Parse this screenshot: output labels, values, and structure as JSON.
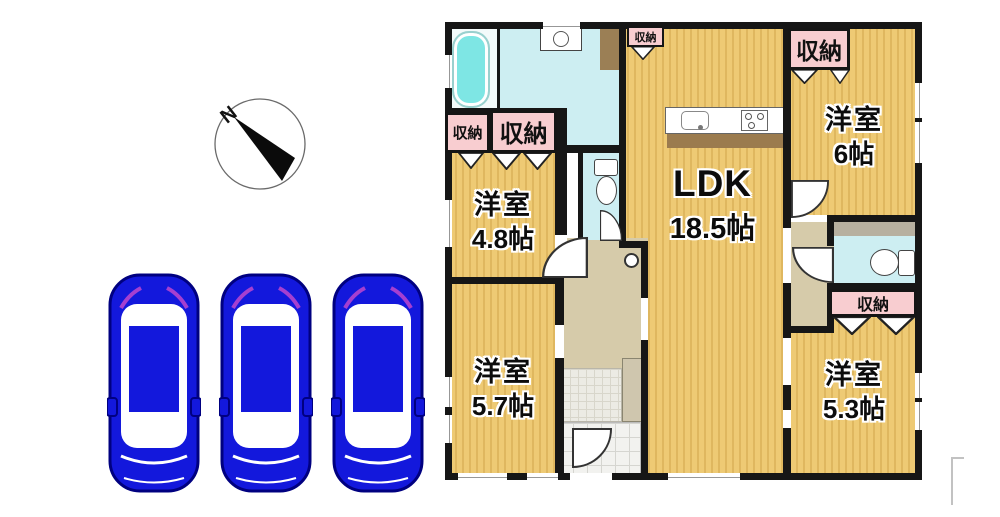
{
  "compass": {
    "label": "N"
  },
  "parking": {
    "spaces": 3
  },
  "plan": {
    "rooms": {
      "ldk": {
        "name": "LDK",
        "size": "18.5帖"
      },
      "western6": {
        "name": "洋室",
        "size": "6帖"
      },
      "western48": {
        "name": "洋室",
        "size": "4.8帖"
      },
      "western57": {
        "name": "洋室",
        "size": "5.7帖"
      },
      "western53": {
        "name": "洋室",
        "size": "5.3帖"
      }
    },
    "closet_label": "収納",
    "colors": {
      "floor": "#eeca74",
      "floor_stripe": "#dfb75f",
      "wall": "#161616",
      "wet_area": "#cdeef2",
      "bathtub": "#7ee6e4",
      "hallway": "#d6cbaa",
      "closet_bg": "#f8cdd0",
      "car": "#1318dc"
    }
  }
}
